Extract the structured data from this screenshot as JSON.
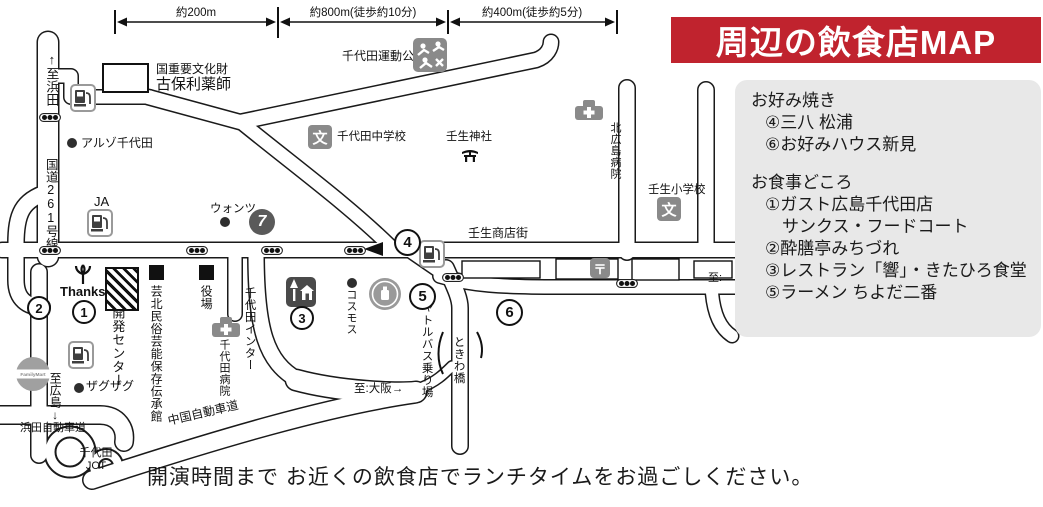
{
  "colors": {
    "banner_bg": "#c0232e",
    "banner_text": "#ffffff",
    "legend_bg": "#e8e8e8",
    "road_line": "#1a1a1a",
    "icon_gray": "#8a8a8a"
  },
  "banner": {
    "title": "周辺の飲食店MAP"
  },
  "scale_bar": {
    "segments": [
      {
        "label": "約200m"
      },
      {
        "label": "約800m(徒歩約10分)"
      },
      {
        "label": "約400m(徒歩約5分)"
      }
    ]
  },
  "legend": {
    "sections": [
      {
        "heading": "お好み焼き",
        "items": [
          "④三八 松浦",
          "⑥お好みハウス新見"
        ]
      },
      {
        "heading": "お食事どころ",
        "items": [
          "①ガスト広島千代田店",
          "　サンクス・フードコート",
          "②酔膳亭みちづれ",
          "③レストラン「響」・きたひろ食堂",
          "⑤ラーメン ちよだ二番"
        ]
      }
    ]
  },
  "caption": "開演時間まで お近くの飲食店でランチタイムをお過ごしください。",
  "map": {
    "labels": {
      "to_hamada": "↑至浜田",
      "route261": "国道261号線",
      "kohori_line1": "国重要文化財",
      "kohori_line2": "古保利薬師",
      "aruzo": "アルゾ千代田",
      "ja": "JA",
      "wants": "ウォンツ",
      "sports_park": "千代田運動公園",
      "junior_high": "千代田中学校",
      "mibu_shrine": "壬生神社",
      "kitahiroshima_hospital": "北広島病院",
      "mibu_elementary": "壬生小学校",
      "mibu_shopping_street": "壬生商店街",
      "thanks": "Thanks",
      "development_center": "開発センター",
      "geihoku_folk_museum": "芸北民俗芸能保存伝承館",
      "town_office": "役場",
      "chiyoda_hospital": "千代田病院",
      "chiyoda_inter": "千代田インター",
      "cosmos": "コスモス",
      "zagzag": "ザグザグ",
      "shuttle_bus_stop": "シャトルバス乗り場",
      "tokiwa_bridge": "ときわ橋",
      "to_hiroshima": "至広島↓",
      "to_osaka": "至:大阪→",
      "to_cutoff": "至:",
      "hamada_expressway": "浜田自動車道",
      "chiyoda_jct": "千代田\nJCT",
      "chugoku_expressway": "中国自動車道"
    },
    "markers": {
      "num1": "1",
      "num2": "2",
      "num3": "3",
      "num4": "4",
      "num5": "5",
      "num6": "6",
      "seven": "7",
      "school_glyph": "文",
      "post_glyph": "〒",
      "familymart": "FamilyMart"
    }
  }
}
